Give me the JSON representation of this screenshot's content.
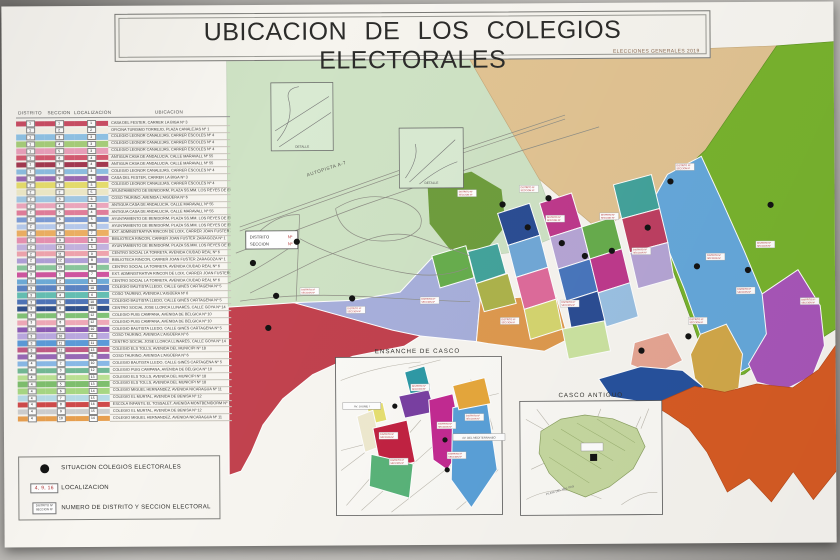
{
  "title": {
    "text": "UBICACION DE LOS COLEGIOS ELECTORALES",
    "subtitle": "ELECCIONES GENERALES 2019"
  },
  "table": {
    "headers": [
      "DISTRITO",
      "SECCION",
      "LOCALIZACION",
      "UBICACION"
    ],
    "rows": [
      {
        "distrito": "1",
        "seccion": "1",
        "localizacion": "1",
        "color": "#cc4f66",
        "ubicacion": "CASA DEL FESTER, CARRER LA BIGA Nº 3"
      },
      {
        "distrito": "1",
        "seccion": "2",
        "localizacion": "2",
        "color": "#f7f3e8",
        "ubicacion": "OFICINA TURISMO TORREJO, PLAZA CANALEJAS Nº 1"
      },
      {
        "distrito": "1",
        "seccion": "3",
        "localizacion": "3",
        "color": "#92c5e8",
        "ubicacion": "COLEGIO LEONOR CANALEJAS, CARRER ESCOLES Nº 4"
      },
      {
        "distrito": "1",
        "seccion": "4",
        "localizacion": "3",
        "color": "#a9d07c",
        "ubicacion": "COLEGIO LEONOR CANALEJAS, CARRER ESCOLES Nº 4"
      },
      {
        "distrito": "1",
        "seccion": "5",
        "localizacion": "3",
        "color": "#eda2bd",
        "ubicacion": "COLEGIO LEONOR CANALEJAS, CARRER ESCOLES Nº 4"
      },
      {
        "distrito": "1",
        "seccion": "6",
        "localizacion": "4",
        "color": "#d75b72",
        "ubicacion": "ANTIGUA CASA DE ANDALUCIA, CALLE MARAVALL Nº 55"
      },
      {
        "distrito": "1",
        "seccion": "7",
        "localizacion": "4",
        "color": "#a63a52",
        "ubicacion": "ANTIGUA CASA DE ANDALUCIA, CALLE MARAVALL Nº 55"
      },
      {
        "distrito": "1",
        "seccion": "8",
        "localizacion": "3",
        "color": "#8fc0e4",
        "ubicacion": "COLEGIO LEONOR CANALEJAS, CARRER ESCOLES Nº 4"
      },
      {
        "distrito": "1",
        "seccion": "9",
        "localizacion": "1",
        "color": "#9d6bb5",
        "ubicacion": "CASA DEL FESTER, CARRER LA BIGA Nº 3"
      },
      {
        "distrito": "2",
        "seccion": "1",
        "localizacion": "3",
        "color": "#e9e06e",
        "ubicacion": "COLEGIO LEONOR CANALEJAS, CARRER ESCOLES Nº 4"
      },
      {
        "distrito": "2",
        "seccion": "2",
        "localizacion": "5",
        "color": "#f1ecca",
        "ubicacion": "AYUNTAMIENTO DE BENIDORM, PLAZA SS.MM. LOS REYES DE ESPAÑA Nº 1"
      },
      {
        "distrito": "2",
        "seccion": "3",
        "localizacion": "6",
        "color": "#a5cce8",
        "ubicacion": "COSO TAURINO, AVENIDA L'AIGÜERA Nº 6"
      },
      {
        "distrito": "2",
        "seccion": "4",
        "localizacion": "4",
        "color": "#f0a9c0",
        "ubicacion": "ANTIGUA CASA DE ANDALUCIA, CALLE MARAVALL Nº 55"
      },
      {
        "distrito": "2",
        "seccion": "5",
        "localizacion": "4",
        "color": "#e57f9d",
        "ubicacion": "ANTIGUA CASA DE ANDALUCIA, CALLE MARAVALL Nº 55"
      },
      {
        "distrito": "2",
        "seccion": "6",
        "localizacion": "5",
        "color": "#7f9fd9",
        "ubicacion": "AYUNTAMIENTO DE BENIDORM, PLAZA SS.MM. LOS REYES DE ESPAÑA Nº 1"
      },
      {
        "distrito": "2",
        "seccion": "7",
        "localizacion": "5",
        "color": "#b9cdf0",
        "ubicacion": "AYUNTAMIENTO DE BENIDORM, PLAZA SS.MM. LOS REYES DE ESPAÑA Nº 1"
      },
      {
        "distrito": "2",
        "seccion": "8",
        "localizacion": "7",
        "color": "#f0b264",
        "ubicacion": "EXT. ADMINISTRATIVA RINCON DE LOIX, CARRER JOAN FUSTER ZARAGOZA Nº 1"
      },
      {
        "distrito": "2",
        "seccion": "9",
        "localizacion": "8",
        "color": "#ea93b4",
        "ubicacion": "BIBLIOTECA RINCON, CARRER JOAN FUSTER ZARAGOZA Nº 1"
      },
      {
        "distrito": "2",
        "seccion": "10",
        "localizacion": "5",
        "color": "#c6b5e2",
        "ubicacion": "AYUNTAMIENTO DE BENIDORM, PLAZA SS.MM. LOS REYES DE ESPAÑA Nº 1"
      },
      {
        "distrito": "2",
        "seccion": "11",
        "localizacion": "9",
        "color": "#f2a6b0",
        "ubicacion": "CENTRO SOCIAL LA TORRETA, AVENIDA CIUDAD REAL Nº 6"
      },
      {
        "distrito": "2",
        "seccion": "12",
        "localizacion": "8",
        "color": "#b2a2da",
        "ubicacion": "BIBLIOTECA RINCON, CARRER JOAN FUSTER ZARAGOZA Nº 1"
      },
      {
        "distrito": "2",
        "seccion": "13",
        "localizacion": "9",
        "color": "#8cc99e",
        "ubicacion": "CENTRO SOCIAL LA TORRETA, AVENIDA CIUDAD REAL Nº 6"
      },
      {
        "distrito": "3",
        "seccion": "1",
        "localizacion": "7",
        "color": "#d257a2",
        "ubicacion": "EXT. ADMINISTRATIVA RINCON DE LOIX, CARRER JOAN FUSTER ZARAGOZA Nº 1"
      },
      {
        "distrito": "3",
        "seccion": "2",
        "localizacion": "9",
        "color": "#6fadda",
        "ubicacion": "CENTRO SOCIAL LA TORRETA, AVENIDA CIUDAD REAL Nº 6"
      },
      {
        "distrito": "3",
        "seccion": "3",
        "localizacion": "10",
        "color": "#5d86c6",
        "ubicacion": "COLEGIO BAUTISTA LLEDO, CALLE GINES CARTAGENA Nº 5"
      },
      {
        "distrito": "3",
        "seccion": "4",
        "localizacion": "6",
        "color": "#66c1b5",
        "ubicacion": "COSO TAURINO, AVENIDA L'AIGÜERA Nº 6"
      },
      {
        "distrito": "3",
        "seccion": "5",
        "localizacion": "10",
        "color": "#5076ba",
        "ubicacion": "COLEGIO BAUTISTA LLEDO, CALLE GINES CARTAGENA Nº 5"
      },
      {
        "distrito": "3",
        "seccion": "6",
        "localizacion": "11",
        "color": "#32528e",
        "ubicacion": "CENTRO SOCIAL JOSE LLORCA LLINARES, CALLE GOYA Nº 14"
      },
      {
        "distrito": "3",
        "seccion": "7",
        "localizacion": "12",
        "color": "#83c478",
        "ubicacion": "COLEGIO PUIG CAMPANA, AVENIDA DE BELGICA Nº 10"
      },
      {
        "distrito": "3",
        "seccion": "8",
        "localizacion": "12",
        "color": "#f2abba",
        "ubicacion": "COLEGIO PUIG CAMPANA, AVENIDA DE BELGICA Nº 10"
      },
      {
        "distrito": "3",
        "seccion": "9",
        "localizacion": "10",
        "color": "#8d5cb6",
        "ubicacion": "COLEGIO BAUTISTA LLEDO, CALLE GINES CARTAGENA Nº 5"
      },
      {
        "distrito": "3",
        "seccion": "10",
        "localizacion": "6",
        "color": "#bcaae2",
        "ubicacion": "COSO TAURINO, AVENIDA L'AIGÜERA Nº 6"
      },
      {
        "distrito": "3",
        "seccion": "11",
        "localizacion": "11",
        "color": "#5c9cda",
        "ubicacion": "CENTRO SOCIAL JOSE LLORCA LLINARES, CALLE GOYA Nº 14"
      },
      {
        "distrito": "3",
        "seccion": "12",
        "localizacion": "13",
        "color": "#c25c86",
        "ubicacion": "COLEGIO ELS TOLLS, AVENIDA DEL MUNICIPI Nº 18"
      },
      {
        "distrito": "4",
        "seccion": "1",
        "localizacion": "6",
        "color": "#996ab8",
        "ubicacion": "COSO TAURINO, AVENIDA L'AIGÜERA Nº 6"
      },
      {
        "distrito": "4",
        "seccion": "2",
        "localizacion": "10",
        "color": "#8abae8",
        "ubicacion": "COLEGIO BAUTISTA LLEDO, CALLE GINES CARTAGENA Nº 5"
      },
      {
        "distrito": "4",
        "seccion": "3",
        "localizacion": "12",
        "color": "#74ba96",
        "ubicacion": "COLEGIO PUIG CAMPANA, AVENIDA DE BELGICA Nº 10"
      },
      {
        "distrito": "4",
        "seccion": "4",
        "localizacion": "13",
        "color": "#bbe294",
        "ubicacion": "COLEGIO ELS TOLLS, AVENIDA DEL MUNICIPI Nº 18"
      },
      {
        "distrito": "4",
        "seccion": "5",
        "localizacion": "13",
        "color": "#7fc06e",
        "ubicacion": "COLEGIO ELS TOLLS, AVENIDA DEL MUNICIPI Nº 18"
      },
      {
        "distrito": "4",
        "seccion": "6",
        "localizacion": "14",
        "color": "#a8d884",
        "ubicacion": "COLEGIO MIGUEL HERNANDEZ, AVENIDA NICARAGUA Nº 11"
      },
      {
        "distrito": "4",
        "seccion": "7",
        "localizacion": "15",
        "color": "#b8dce8",
        "ubicacion": "COLEGIO EL MURTAL, AVENIDA DE BENISA Nº 12"
      },
      {
        "distrito": "4",
        "seccion": "8",
        "localizacion": "16",
        "color": "#d04b4b",
        "ubicacion": "ESCOLA INFANTIL EL TOSSALET, AVENIDA MONTBENIDORM Nº 1"
      },
      {
        "distrito": "4",
        "seccion": "9",
        "localizacion": "15",
        "color": "#cfcfcf",
        "ubicacion": "COLEGIO EL MURTAL, AVENIDA DE BENISA Nº 12"
      },
      {
        "distrito": "4",
        "seccion": "10",
        "localizacion": "14",
        "color": "#e8a050",
        "ubicacion": "COLEGIO MIGUEL HERNANDEZ, AVENIDA NICARAGUA Nº 11"
      }
    ]
  },
  "key": {
    "situacion": "SITUACION COLEGIOS ELECTORALES",
    "localizacion_sample": "4, 9, 16",
    "localizacion_label": "LOCALIZACION",
    "distrito_line1": "DISTRITO Nº",
    "distrito_line2": "SECCION Nº",
    "distrito_label": "NUMERO DE DISTRITO Y SECCION ELECTORAL"
  },
  "map": {
    "labels": {
      "autopista": "AUTOPISTA A-7",
      "detalle": "DETALLE",
      "distrito_word": "DISTRITO",
      "seccion_word": "SECCION",
      "num": "Nº",
      "chip_line1": "DISTRITO Nº",
      "chip_line2": "SECCION Nº"
    },
    "insets": {
      "ensanche_title": "ENSANCHE DE CASCO",
      "casco_title": "CASCO ANTIGUO",
      "playa": "PLAYA DEL MAL PAS",
      "banner1": "AV. JAUME I",
      "banner2": "AV. DEL MEDITERRANEO"
    },
    "palette": {
      "rural": "#cfe3c5",
      "rural_inset": "#d9ead2",
      "tan": "#e2c493",
      "green": "#79b42e",
      "olive": "#6f9e3e",
      "lavender": "#a8b0dc",
      "orange_w": "#df9a4f",
      "red_pon": "#c2424f",
      "blue_strip": "#66a9dc",
      "purple_e": "#a957ba",
      "gold": "#d3a94a",
      "salmon": "#e7a694",
      "darkblue": "#27529e",
      "headland": "#d85c24",
      "u_teal": "#44a49c",
      "u_olive": "#aeb44c",
      "u_dkblue": "#2c4e94",
      "u_ltblue": "#72a9d8",
      "u_magenta": "#bf3a8d",
      "u_lav": "#b7a6d6",
      "u_pink": "#df6c9c",
      "u_blue": "#4a77be",
      "u_green": "#68ae4e",
      "u_crimson": "#bf4062",
      "u_paleblue": "#9cc2e4",
      "u_yellow": "#d6d670",
      "u_pgreen": "#cde4a2",
      "e_teal": "#2f9aa6",
      "e_purple": "#7a40a2",
      "e_magenta": "#c32b92",
      "e_red": "#c22342",
      "e_green": "#5ab47a",
      "e_blue": "#5ba1d9",
      "e_orange": "#e7a83c",
      "e_yellow": "#e7e071",
      "e_cream": "#efead0",
      "c_green": "#c7d9a1",
      "dot": "#141414",
      "chip_text": "#b03030"
    }
  }
}
